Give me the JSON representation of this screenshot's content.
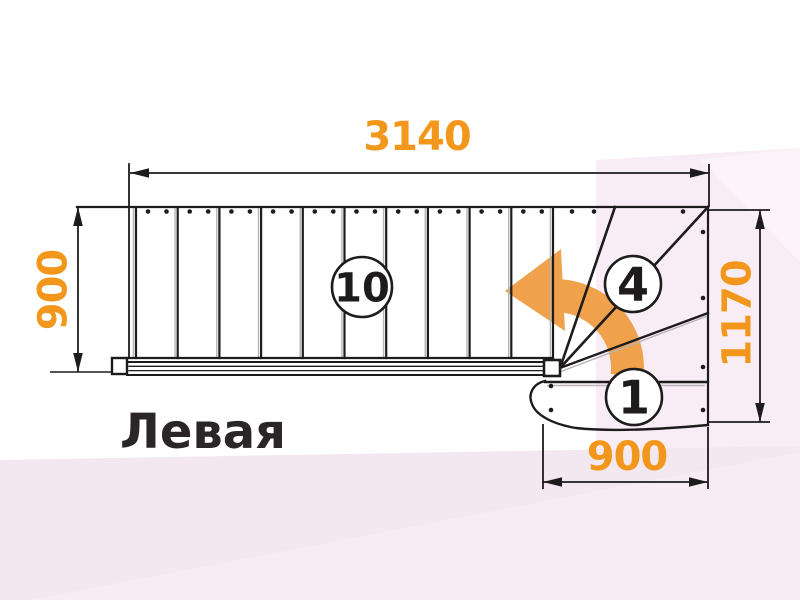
{
  "diagram": {
    "type": "staircase-plan",
    "title": "Левая",
    "dimensions": {
      "top_width": "3140",
      "left_depth": "900",
      "right_height": "1170",
      "bottom_width": "900"
    },
    "step_counts": {
      "straight_flight": "10",
      "winders": "4",
      "first_step": "1"
    },
    "stair": {
      "straight_treads": 10,
      "winder_treads": 4,
      "bottom_steps": 1,
      "turn_direction": "left"
    },
    "colors": {
      "dimension_text": "#F2971B",
      "turn_arrow": "#EFA14C",
      "drawing_lines": "#1D1B1B",
      "title_text": "#2A2527",
      "background_tint": "#F3E8EF"
    }
  }
}
